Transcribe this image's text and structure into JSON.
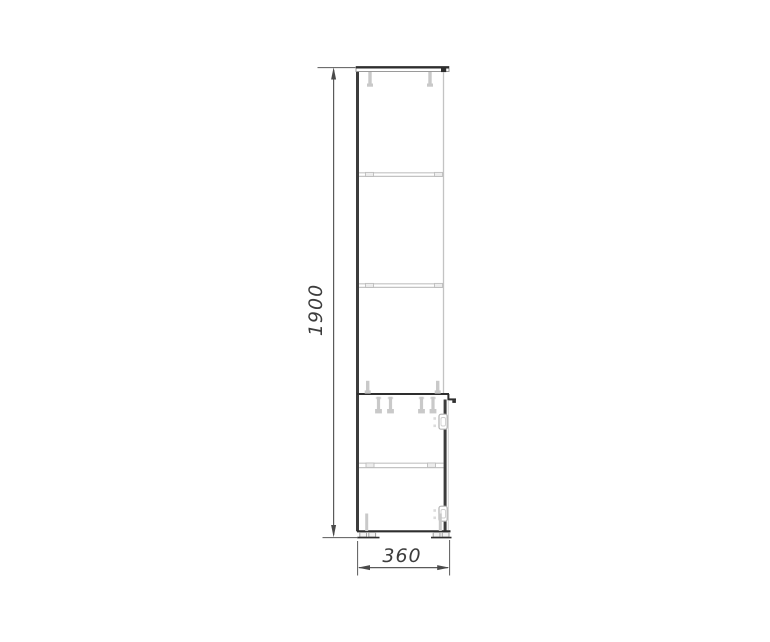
{
  "canvas": {
    "background": "#ffffff"
  },
  "colors": {
    "primary_outline": "#2e2e2e",
    "secondary_line": "#c3c3c3",
    "fitting_fill": "#c9c9c9",
    "dimension_line": "#5a5a5a",
    "dimension_text": "#3d3d3d"
  },
  "dimensions": {
    "height": {
      "label": "1900"
    },
    "width": {
      "label": "360"
    }
  }
}
